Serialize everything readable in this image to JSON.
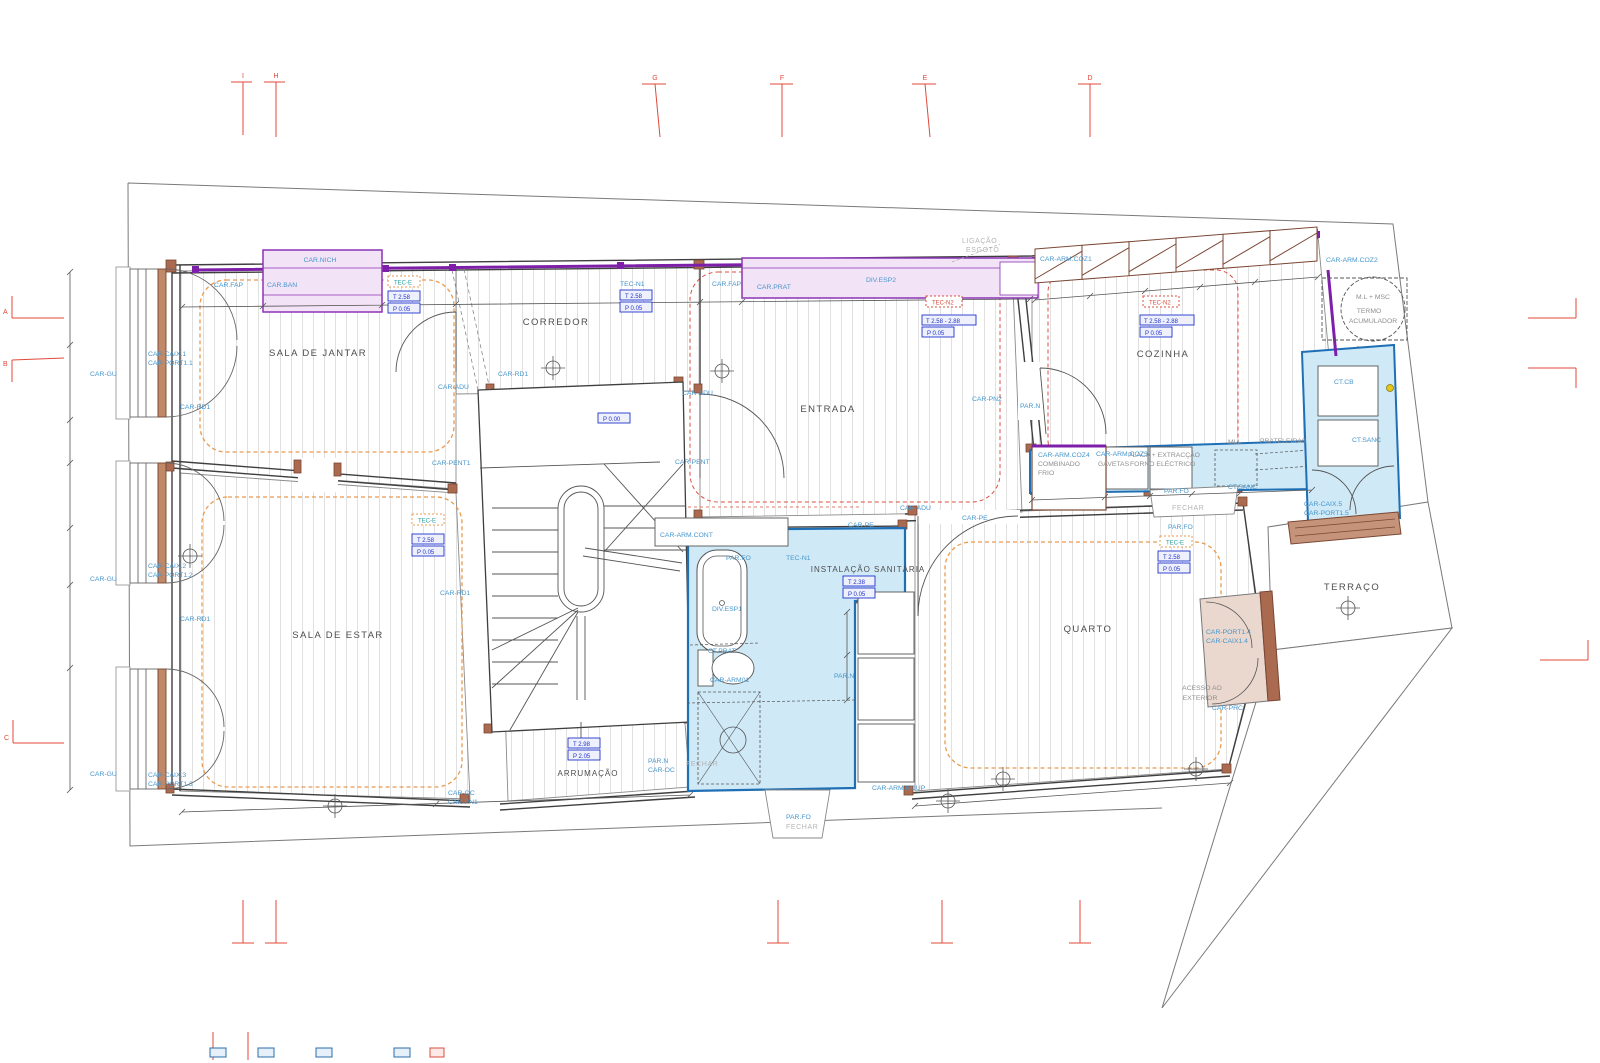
{
  "rooms": {
    "sala_de_jantar": "SALA DE JANTAR",
    "corredor": "CORREDOR",
    "entrada": "ENTRADA",
    "cozinha": "COZINHA",
    "sala_de_estar": "SALA DE ESTAR",
    "instalacao_sanitaria": "INSTALAÇÃO SANITÁRIA",
    "quarto": "QUARTO",
    "arrumacao": "ARRUMAÇÃO",
    "terraco": "TERRAÇO",
    "acesso_line1": "ACESSO AO",
    "acesso_line2": "EXTERIOR"
  },
  "annex": {
    "ligacao": "LIGAÇÃO",
    "esgoto": "ESGOTO",
    "ml_msc": "M.L + MSC",
    "termo_line1": "TERMO",
    "termo_line2": "ACUMULADOR"
  },
  "fixtures": {
    "prateleiras": "PRATELEIRAS",
    "mll": "MLL",
    "placa": "PLACA + EXTRACÇÃO",
    "forno": "FORNO ELÉCTRICO",
    "combinado": "COMBINADO",
    "frio": "FRIO",
    "gavetas": "GAVETAS",
    "fechar": "FECHAR"
  },
  "tags": {
    "car_nich": "CAR.NICH",
    "car_fap": "CAR.FAP",
    "car_ban": "CAR.BAN",
    "car_prat": "CAR.PRAT",
    "div_esp1": "DIV.ESP1",
    "div_esp2": "DIV.ESP2",
    "car_gu": "CAR-GU",
    "car_rd1": "CAR-RD1",
    "car_adu": "CAR-ADU",
    "car_pent": "CAR-PENT",
    "car_pent1": "CAR-PENT1",
    "car_caix1": "CAR-CAIX.1",
    "car_port1_1": "CAR-PORT1.1",
    "car_caix2": "CAR-CAIX.2",
    "car_port1_2": "CAR-PORT1.2",
    "car_caix3": "CAR-CAIX.3",
    "car_port1_3": "CAR-PORT1.3",
    "car_caix5": "CAR-CAIX.5",
    "car_port1_5": "CAR-PORT1.5",
    "car_port1_4": "CAR-PORT1.4",
    "car_caix1_4": "CAR-CAIX1.4",
    "car_prc": "CAR-PRC",
    "car_pn1": "CAR-PN1",
    "car_pn2": "CAR-PN2",
    "car_oc": "CAR-OC",
    "car_pe": "CAR-PE",
    "par_n": "PAR.N",
    "par_fo": "PAR.FO",
    "ct_prat": "CT.PRAT",
    "ct_sanc": "CT.SANC",
    "ct_cb": "CT.CB",
    "car_arm01": "CAR-ARM01",
    "car_arm_cont": "CAR-ARM.CONT",
    "car_arm_roup": "CAR-ARM.ROUP",
    "car_arm_coz1": "CAR-ARM.COZ1",
    "car_arm_coz2": "CAR-ARM.COZ2",
    "car_arm_coz3": "CAR-ARM.COZ3",
    "car_arm_coz4": "CAR-ARM.COZ4"
  },
  "tec": {
    "tec_e": "TEC-E",
    "tec_n1": "TEC-N1",
    "tec_n2": "TEC-N2"
  },
  "levels": {
    "t_258": "T 2.58",
    "p_005": "P 0.05",
    "t_range": "T 2.58 - 2.88",
    "t_238": "T 2.38",
    "t_298": "T 2.98",
    "p_205": "P 2.05",
    "p_000": "P 0.00"
  },
  "grid": {
    "a": "A",
    "b": "B",
    "c": "C",
    "d": "D",
    "e": "E",
    "f": "F",
    "g": "G",
    "h": "H",
    "i": "I"
  },
  "colors": {
    "purple": "#7d1fa8",
    "pink_fill": "#f3e3f6",
    "blue_fill": "#cfe9f7",
    "blue_stroke": "#1f6fb5",
    "label_blue": "#4796cc",
    "value_blue": "#2233cc",
    "marker_red": "#e0483a",
    "orange": "#e89a50",
    "brown": "#7a4632",
    "wall_gray": "#3f3f3f",
    "hatch_gray": "#d9d9d9",
    "text_dark": "#4d4d4d",
    "text_gray": "#8f8f8f",
    "yellow_dot": "#e8c619"
  }
}
